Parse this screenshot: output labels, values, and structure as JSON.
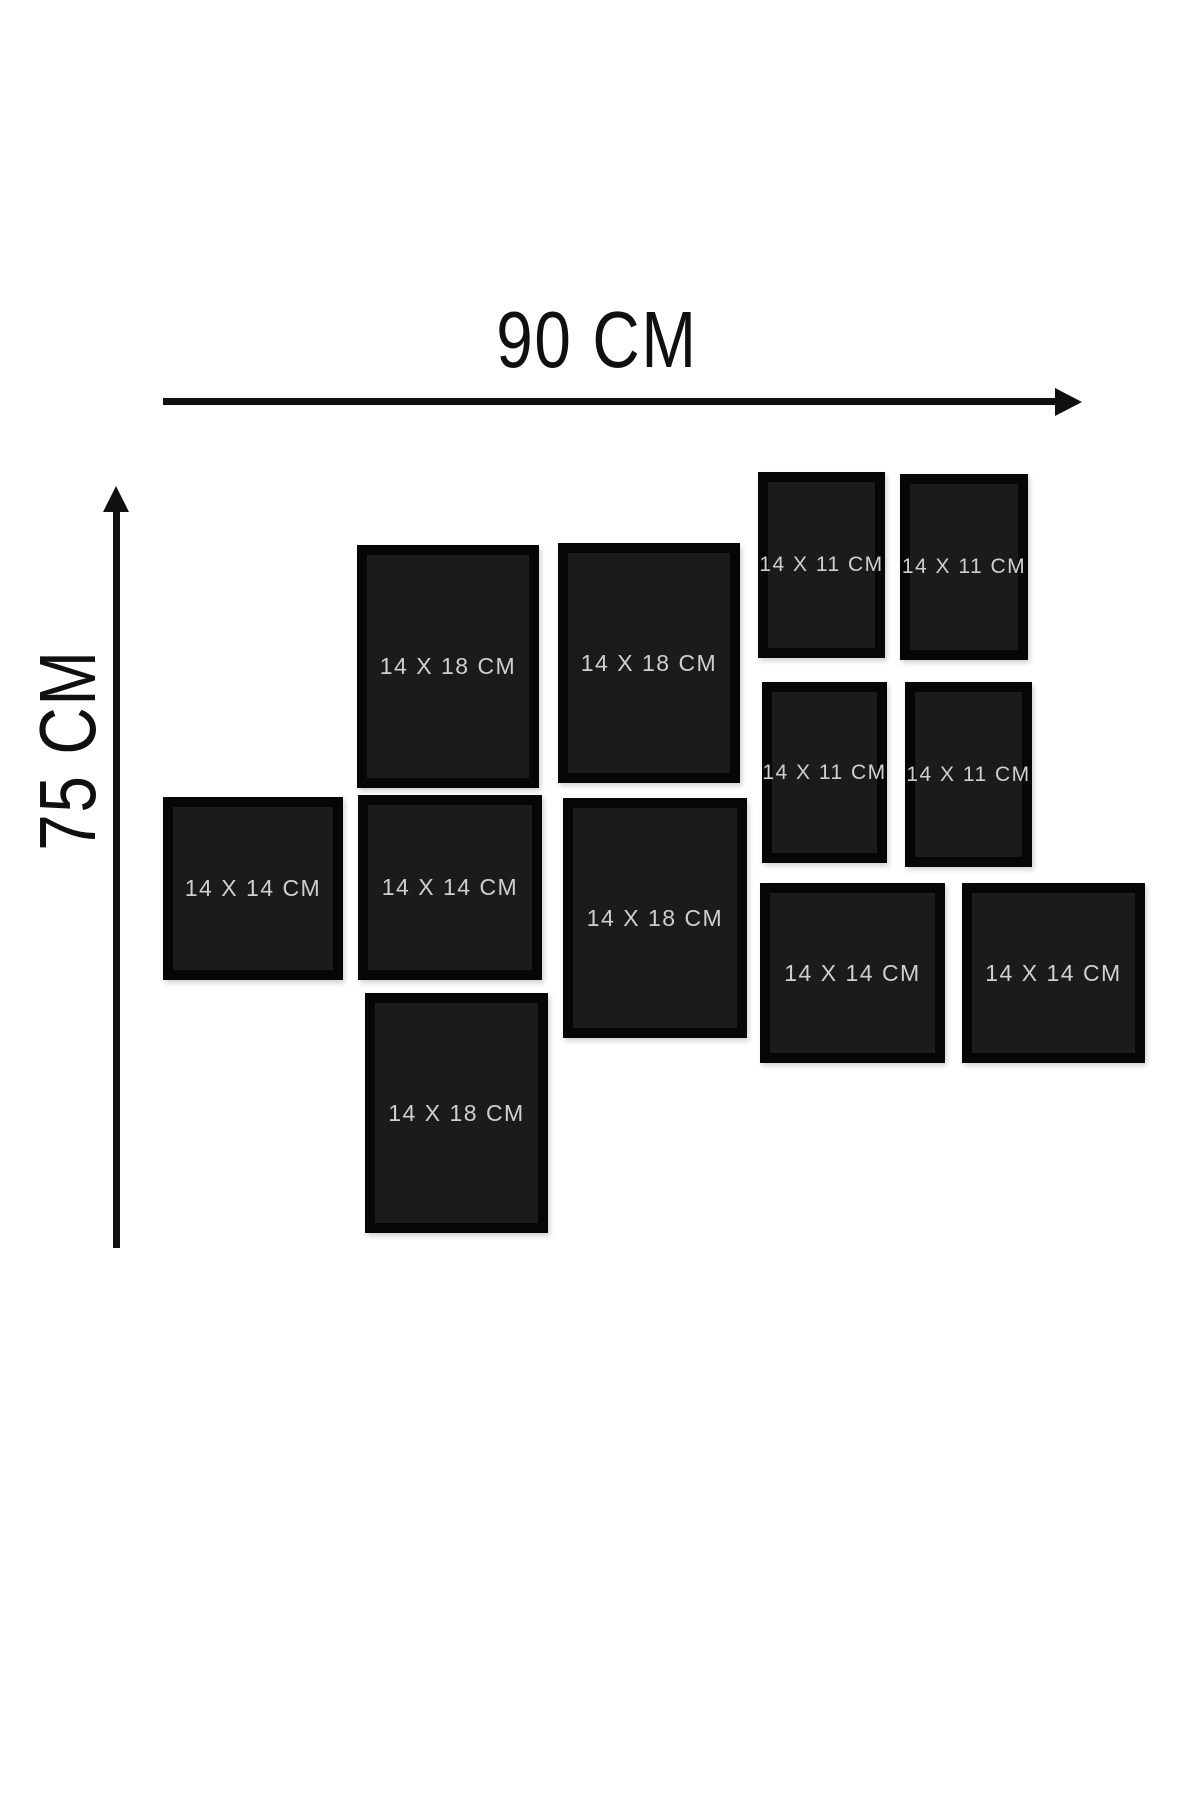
{
  "diagram_title": "wall-frame-collage-size-diagram",
  "dimensions": {
    "width_label": "90 CM",
    "height_label": "75 CM"
  },
  "colors": {
    "canvas_bg": "#ffffff",
    "arrow": "#101010",
    "frame_border": "#060606",
    "frame_fill": "#1b1b1b",
    "frame_label_text": "#cfcfcf"
  },
  "frames": [
    {
      "label": "14 X 18 CM",
      "size": "14x18",
      "x": 357,
      "y": 545,
      "w": 182,
      "h": 243
    },
    {
      "label": "14 X 18 CM",
      "size": "14x18",
      "x": 558,
      "y": 543,
      "w": 182,
      "h": 240
    },
    {
      "label": "14 X 11 CM",
      "size": "14x11",
      "x": 758,
      "y": 472,
      "w": 127,
      "h": 186
    },
    {
      "label": "14 X 11 CM",
      "size": "14x11",
      "x": 900,
      "y": 474,
      "w": 128,
      "h": 186
    },
    {
      "label": "14 X 11 CM",
      "size": "14x11",
      "x": 762,
      "y": 682,
      "w": 125,
      "h": 181
    },
    {
      "label": "14 X 11 CM",
      "size": "14x11",
      "x": 905,
      "y": 682,
      "w": 127,
      "h": 185
    },
    {
      "label": "14 X 14 CM",
      "size": "14x14",
      "x": 163,
      "y": 797,
      "w": 180,
      "h": 183
    },
    {
      "label": "14 X 14 CM",
      "size": "14x14",
      "x": 358,
      "y": 795,
      "w": 184,
      "h": 185
    },
    {
      "label": "14 X 18 CM",
      "size": "14x18",
      "x": 563,
      "y": 798,
      "w": 184,
      "h": 240
    },
    {
      "label": "14 X 14 CM",
      "size": "14x14",
      "x": 760,
      "y": 883,
      "w": 185,
      "h": 180
    },
    {
      "label": "14 X 14 CM",
      "size": "14x14",
      "x": 962,
      "y": 883,
      "w": 183,
      "h": 180
    },
    {
      "label": "14 X 18 CM",
      "size": "14x18",
      "x": 365,
      "y": 993,
      "w": 183,
      "h": 240
    }
  ]
}
